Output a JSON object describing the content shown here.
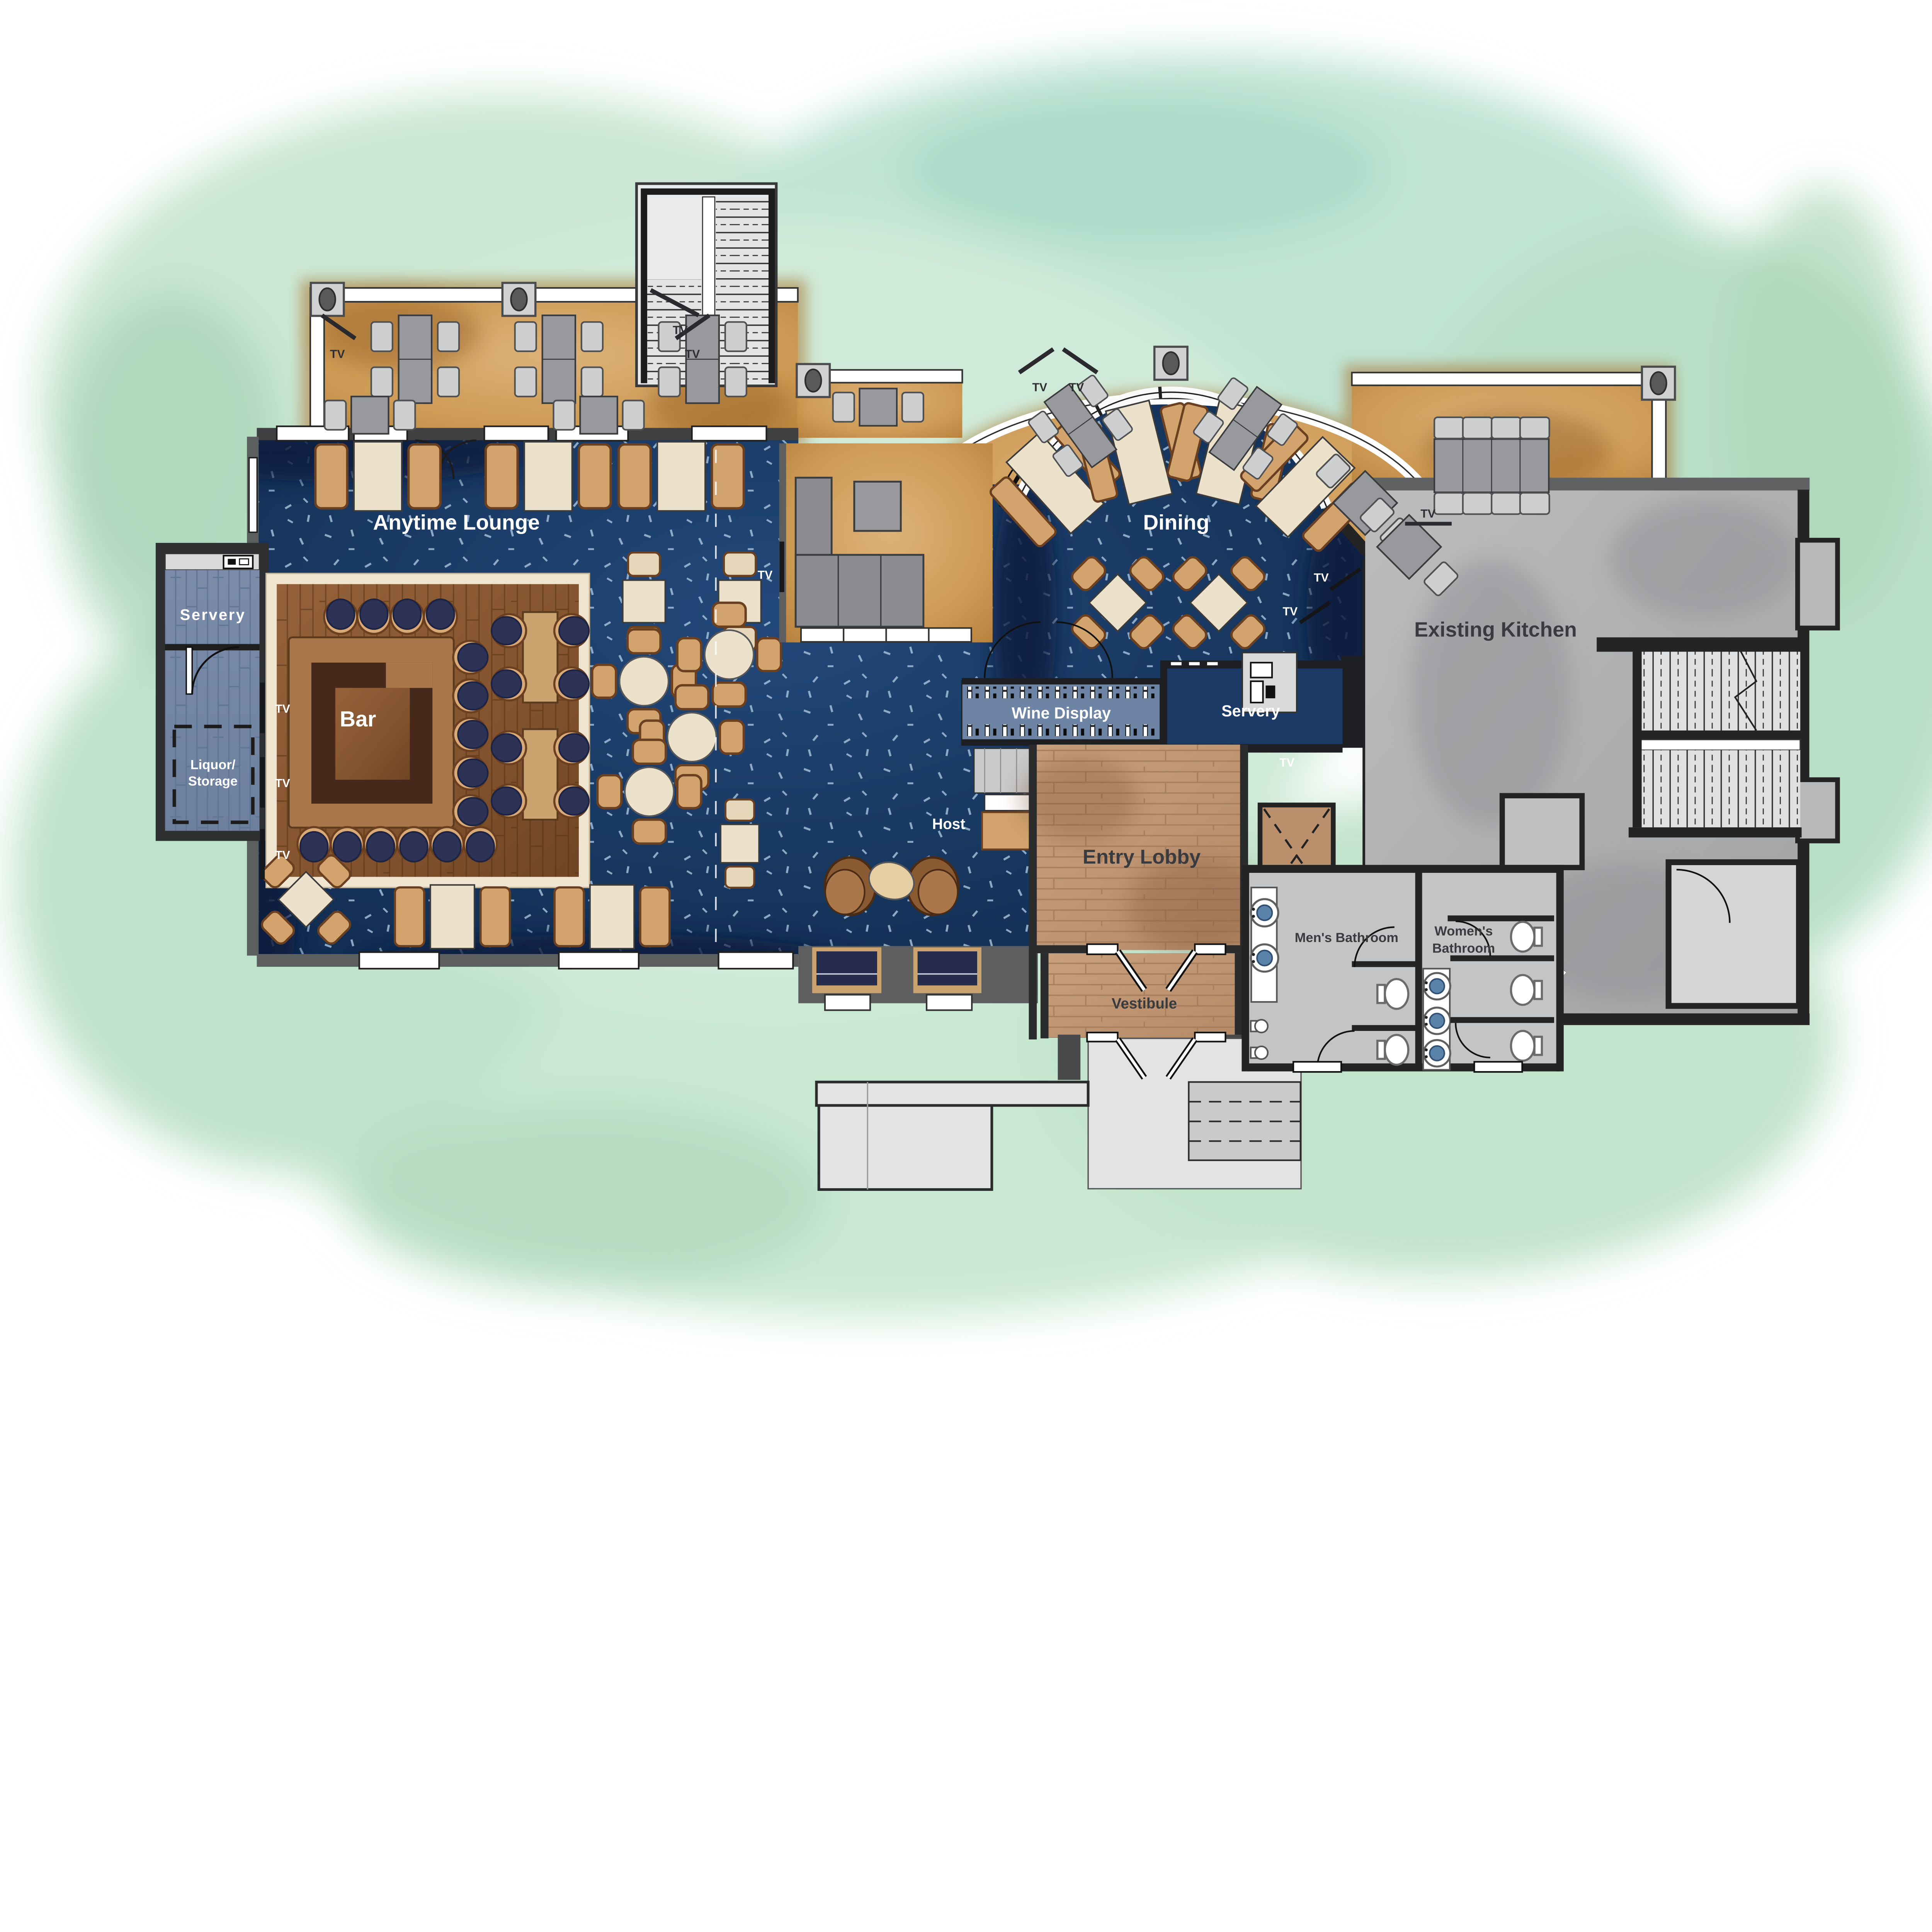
{
  "page": {
    "title": "Restaurant Floor Plan"
  },
  "rooms": {
    "anytime_lounge": "Anytime Lounge",
    "bar": "Bar",
    "servery_west": "Servery",
    "liquor_storage_line1": "Liquor/",
    "liquor_storage_line2": "Storage",
    "dining": "Dining",
    "wine_display": "Wine Display",
    "servery_east": "Servery",
    "host": "Host",
    "entry_lobby": "Entry Lobby",
    "vestibule": "Vestibule",
    "mens_bathroom": "Men's Bathroom",
    "womens_bathroom_line1": "Women's",
    "womens_bathroom_line2": "Bathroom",
    "existing_kitchen": "Existing Kitchen"
  },
  "labels": {
    "tv": "TV"
  },
  "palette": {
    "background_wash_green": "#c6e5d0",
    "carpet_navy": "#1a3a66",
    "carpet_speckle": "#a9c6e0",
    "terrace_tan": "#c9954f",
    "bar_wood": "#8a5a33",
    "bar_counter": "#a9774a",
    "bar_counter_dark": "#46291a",
    "stool_navy": "#2c3357",
    "chair_tan": "#d2a36d",
    "table_cream": "#ece1cb",
    "servery_tile": "#7488a6",
    "wine_display_blue": "#6e84a4",
    "lobby_wood": "#c49b79",
    "kitchen_gray": "#b3b4b6",
    "wall_dark": "#242424",
    "wall_gray": "#5c5e60",
    "railing_white": "#ffffff",
    "label_white": "#ffffff",
    "label_dark": "#3a3b3e"
  }
}
